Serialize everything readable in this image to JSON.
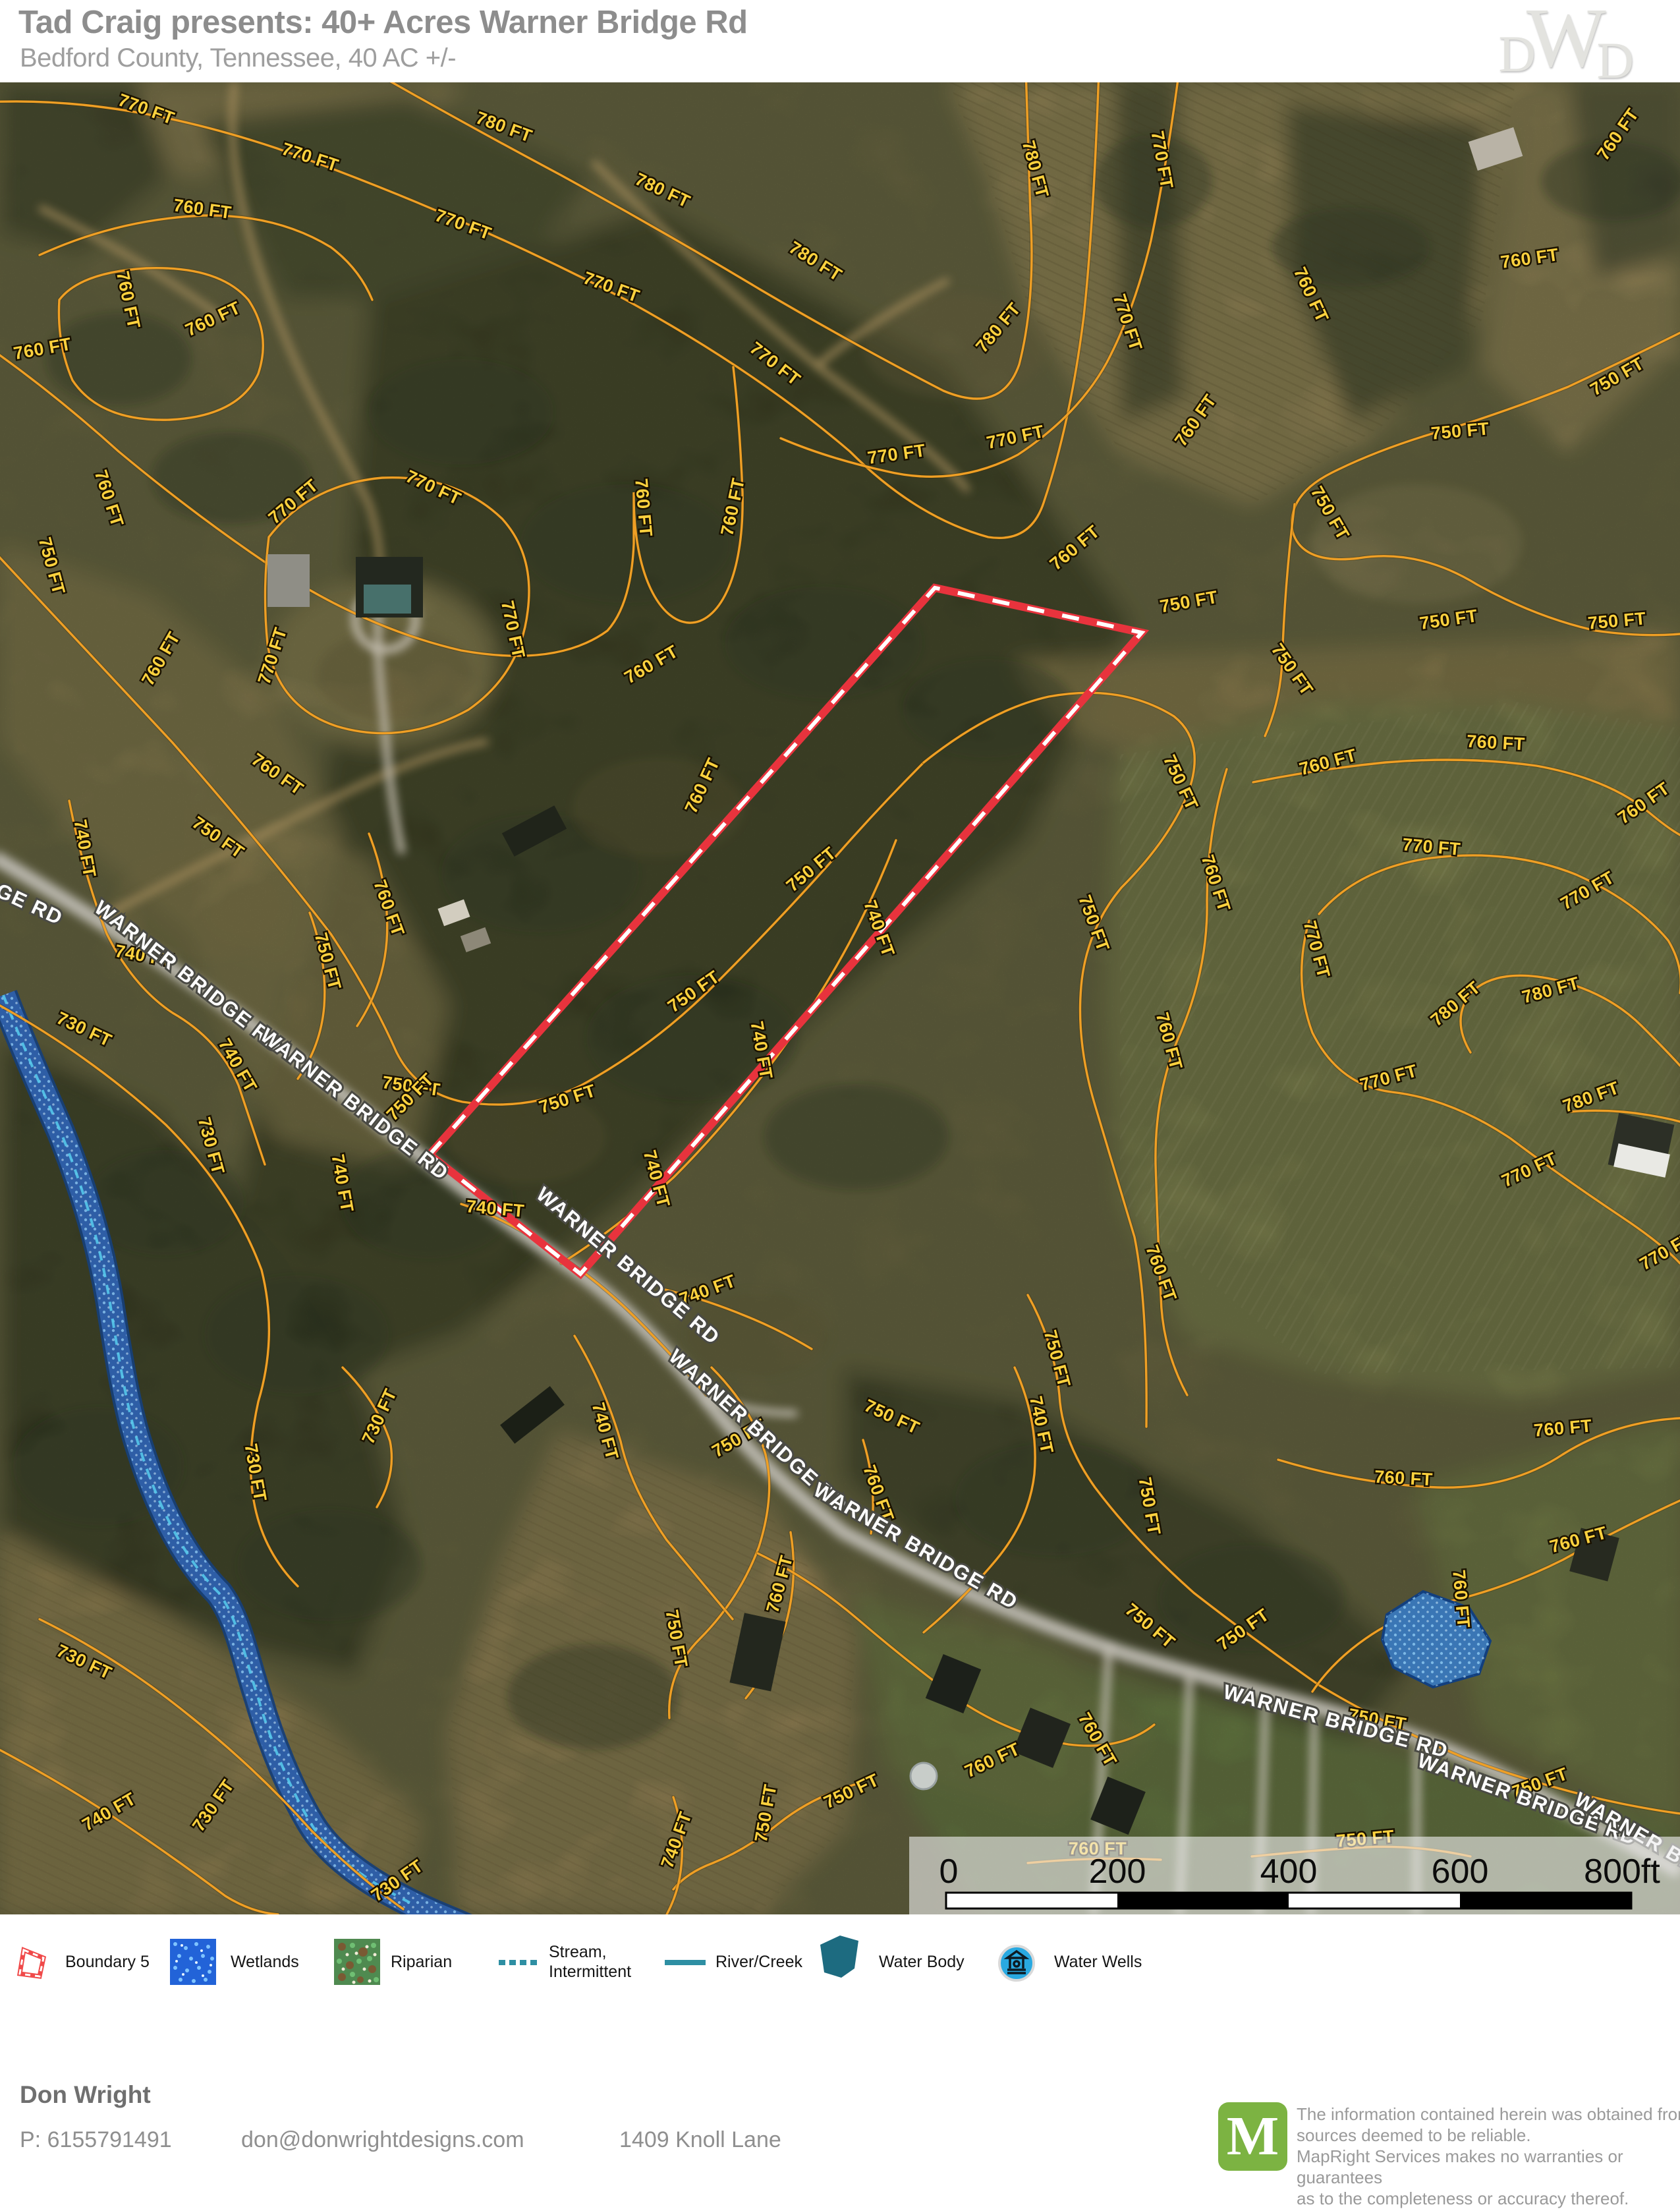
{
  "header": {
    "title": "Tad Craig presents: 40+ Acres Warner Bridge Rd",
    "subtitle": "Bedford County, Tennessee, 40 AC +/-",
    "logo_parts": [
      "D",
      "W",
      "D"
    ]
  },
  "map": {
    "road_name": "WARNER BRIDGE RD",
    "road_labels": [
      [
        "WARNER BRIDGE RD",
        -70,
        1205,
        25
      ],
      [
        "WARNER BRIDGE RD",
        280,
        1365,
        38
      ],
      [
        "WARNER BRIDGE RD",
        532,
        1559,
        38
      ],
      [
        "WARNER BRIDGE RD",
        947,
        1804,
        40
      ],
      [
        "WARNER BRIDGE RD",
        1144,
        2054,
        42
      ],
      [
        "WARNER BRIDGE RD",
        1385,
        2230,
        30
      ],
      [
        "WARNER BRIDGE RD",
        2025,
        2497,
        15
      ],
      [
        "WARNER BRIDGE RD",
        2315,
        2615,
        20
      ],
      [
        "WARNER BRIDGE RD",
        2540,
        2700,
        30
      ]
    ],
    "contour_labels": [
      [
        "770 FT",
        219,
        49,
        20
      ],
      [
        "780 FT",
        762,
        76,
        20
      ],
      [
        "770 FT",
        468,
        122,
        18
      ],
      [
        "780 FT",
        1002,
        172,
        25
      ],
      [
        "760 FT",
        306,
        201,
        8
      ],
      [
        "770 FT",
        700,
        224,
        20
      ],
      [
        "780 FT",
        1233,
        279,
        32
      ],
      [
        "760 FT",
        186,
        332,
        78
      ],
      [
        "770 FT",
        925,
        319,
        20
      ],
      [
        "760 FT",
        327,
        367,
        -25
      ],
      [
        "760 FT",
        66,
        413,
        -10
      ],
      [
        "770 FT",
        1171,
        434,
        38
      ],
      [
        "760 FT",
        157,
        634,
        72
      ],
      [
        "770 FT",
        654,
        623,
        25
      ],
      [
        "770 FT",
        451,
        643,
        -40
      ],
      [
        "760 FT",
        968,
        646,
        85
      ],
      [
        "760 FT",
        1121,
        646,
        -78
      ],
      [
        "750 FT",
        70,
        736,
        75
      ],
      [
        "770 FT",
        770,
        832,
        78
      ],
      [
        "760 FT",
        252,
        879,
        -60
      ],
      [
        "770 FT",
        422,
        873,
        -72
      ],
      [
        "760 FT",
        993,
        891,
        -30
      ],
      [
        "780 FT",
        1563,
        134,
        75
      ],
      [
        "770 FT",
        1755,
        119,
        80
      ],
      [
        "760 FT",
        2463,
        84,
        -55
      ],
      [
        "760 FT",
        2323,
        276,
        -8
      ],
      [
        "760 FT",
        1982,
        326,
        65
      ],
      [
        "780 FT",
        1522,
        378,
        -50
      ],
      [
        "770 FT",
        1703,
        367,
        72
      ],
      [
        "750 FT",
        2459,
        454,
        -30
      ],
      [
        "770 FT",
        1543,
        547,
        -12
      ],
      [
        "760 FT",
        1822,
        518,
        -55
      ],
      [
        "750 FT",
        2217,
        538,
        -5
      ],
      [
        "770 FT",
        1362,
        573,
        -8
      ],
      [
        "750 FT",
        2011,
        658,
        60
      ],
      [
        "760 FT",
        1637,
        713,
        -40
      ],
      [
        "750 FT",
        1806,
        797,
        -10
      ],
      [
        "750 FT",
        2200,
        824,
        -8
      ],
      [
        "750 FT",
        2455,
        826,
        -5
      ],
      [
        "750 FT",
        1954,
        896,
        55
      ],
      [
        "750 FT",
        1237,
        1201,
        -40
      ],
      [
        "760 FT",
        1074,
        1071,
        -65
      ],
      [
        "750 FT",
        1058,
        1387,
        -35
      ],
      [
        "750 FT",
        864,
        1551,
        -18
      ],
      [
        "750 FT",
        623,
        1532,
        8
      ],
      [
        "740 FT",
        1326,
        1287,
        70
      ],
      [
        "740 FT",
        1147,
        1470,
        80
      ],
      [
        "740 FT",
        988,
        1666,
        75
      ],
      [
        "740 FT",
        751,
        1718,
        5
      ],
      [
        "740 FT",
        1077,
        1841,
        -20
      ],
      [
        "750 FT",
        1784,
        1066,
        65
      ],
      [
        "760 FT",
        2018,
        1040,
        -15
      ],
      [
        "760 FT",
        2270,
        1011,
        3
      ],
      [
        "760 FT",
        2500,
        1101,
        -35
      ],
      [
        "750 FT",
        1652,
        1279,
        70
      ],
      [
        "760 FT",
        1837,
        1218,
        72
      ],
      [
        "770 FT",
        2172,
        1169,
        5
      ],
      [
        "770 FT",
        2414,
        1234,
        -30
      ],
      [
        "770 FT",
        1990,
        1318,
        75
      ],
      [
        "780 FT",
        2215,
        1405,
        -40
      ],
      [
        "780 FT",
        2356,
        1386,
        -15
      ],
      [
        "760 FT",
        1766,
        1457,
        75
      ],
      [
        "770 FT",
        2110,
        1519,
        -15
      ],
      [
        "780 FT",
        2418,
        1548,
        -20
      ],
      [
        "770 FT",
        2325,
        1658,
        -25
      ],
      [
        "760 FT",
        1754,
        1810,
        70
      ],
      [
        "770 FT",
        2534,
        1781,
        -30
      ],
      [
        "740 FT",
        120,
        1164,
        80
      ],
      [
        "760 FT",
        416,
        1057,
        35
      ],
      [
        "750 FT",
        326,
        1153,
        35
      ],
      [
        "740 FT",
        217,
        1334,
        10
      ],
      [
        "730 FT",
        124,
        1445,
        25
      ],
      [
        "750 FT",
        489,
        1336,
        75
      ],
      [
        "760 FT",
        582,
        1256,
        70
      ],
      [
        "730 FT",
        312,
        1616,
        75
      ],
      [
        "740 FT",
        353,
        1496,
        60
      ],
      [
        "750 FT",
        629,
        1546,
        -45
      ],
      [
        "740 FT",
        511,
        1672,
        80
      ],
      [
        "730 FT",
        584,
        2028,
        -65
      ],
      [
        "730 FT",
        379,
        2111,
        80
      ],
      [
        "740 FT",
        910,
        2049,
        75
      ],
      [
        "750 FT",
        1126,
        2065,
        -30
      ],
      [
        "760 FT",
        1192,
        2281,
        -75
      ],
      [
        "750 FT",
        1018,
        2363,
        80
      ],
      [
        "730 FT",
        124,
        2405,
        25
      ],
      [
        "730 FT",
        331,
        2620,
        -55
      ],
      [
        "740 FT",
        170,
        2632,
        -30
      ],
      [
        "730 FT",
        608,
        2736,
        -35
      ],
      [
        "750 FT",
        1171,
        2628,
        -80
      ],
      [
        "740 FT",
        1035,
        2670,
        -70
      ],
      [
        "750 FT",
        1596,
        1939,
        75
      ],
      [
        "740 FT",
        1572,
        2039,
        78
      ],
      [
        "750 FT",
        1350,
        2033,
        25
      ],
      [
        "760 FT",
        1325,
        2144,
        70
      ],
      [
        "760 FT",
        2130,
        2127,
        3
      ],
      [
        "760 FT",
        2373,
        2051,
        -5
      ],
      [
        "750 FT",
        1736,
        2162,
        80
      ],
      [
        "760 FT",
        2398,
        2220,
        -15
      ],
      [
        "750 FT",
        1892,
        2355,
        -35
      ],
      [
        "760 FT",
        2209,
        2302,
        85
      ],
      [
        "750 FT",
        1740,
        2349,
        40
      ],
      [
        "760 FT",
        1510,
        2554,
        -25
      ],
      [
        "760 FT",
        1658,
        2519,
        60
      ],
      [
        "750 FT",
        2089,
        2493,
        10
      ],
      [
        "750 FT",
        2340,
        2589,
        -20
      ],
      [
        "750 FT",
        1296,
        2601,
        -25
      ],
      [
        "750 FT",
        2073,
        2674,
        -5
      ],
      [
        "760 FT",
        1666,
        2689,
        0
      ]
    ],
    "scale_bar": {
      "labels": [
        "0",
        "200",
        "400",
        "600",
        "800ft"
      ]
    }
  },
  "legend": {
    "items": [
      {
        "type": "boundary",
        "label": "Boundary 5"
      },
      {
        "type": "wetlands",
        "label": "Wetlands"
      },
      {
        "type": "riparian",
        "label": "Riparian"
      },
      {
        "type": "stream",
        "label": "Stream,\nIntermittent"
      },
      {
        "type": "river",
        "label": "River/Creek"
      },
      {
        "type": "waterbody",
        "label": "Water Body"
      },
      {
        "type": "wells",
        "label": "Water Wells"
      }
    ]
  },
  "footer": {
    "name": "Don Wright",
    "phone": "P: 6155791491",
    "email": "don@donwrightdesigns.com",
    "address": "1409 Knoll Lane"
  },
  "disclaimer": {
    "logo_letter": "M",
    "lines": [
      "The information contained herein was obtained from",
      "sources deemed to be reliable.",
      " MapRight Services makes no warranties or guarantees",
      "as to the completeness or accuracy thereof."
    ]
  },
  "colors": {
    "contour": "#ef9f25",
    "contour_label": "#ffd23e",
    "boundary_red": "#e8333d",
    "river_blue": "#2a569c",
    "legend_teal": "#2e8fa3",
    "wells_blue": "#29a9e1",
    "mapright_green": "#7cb342"
  }
}
